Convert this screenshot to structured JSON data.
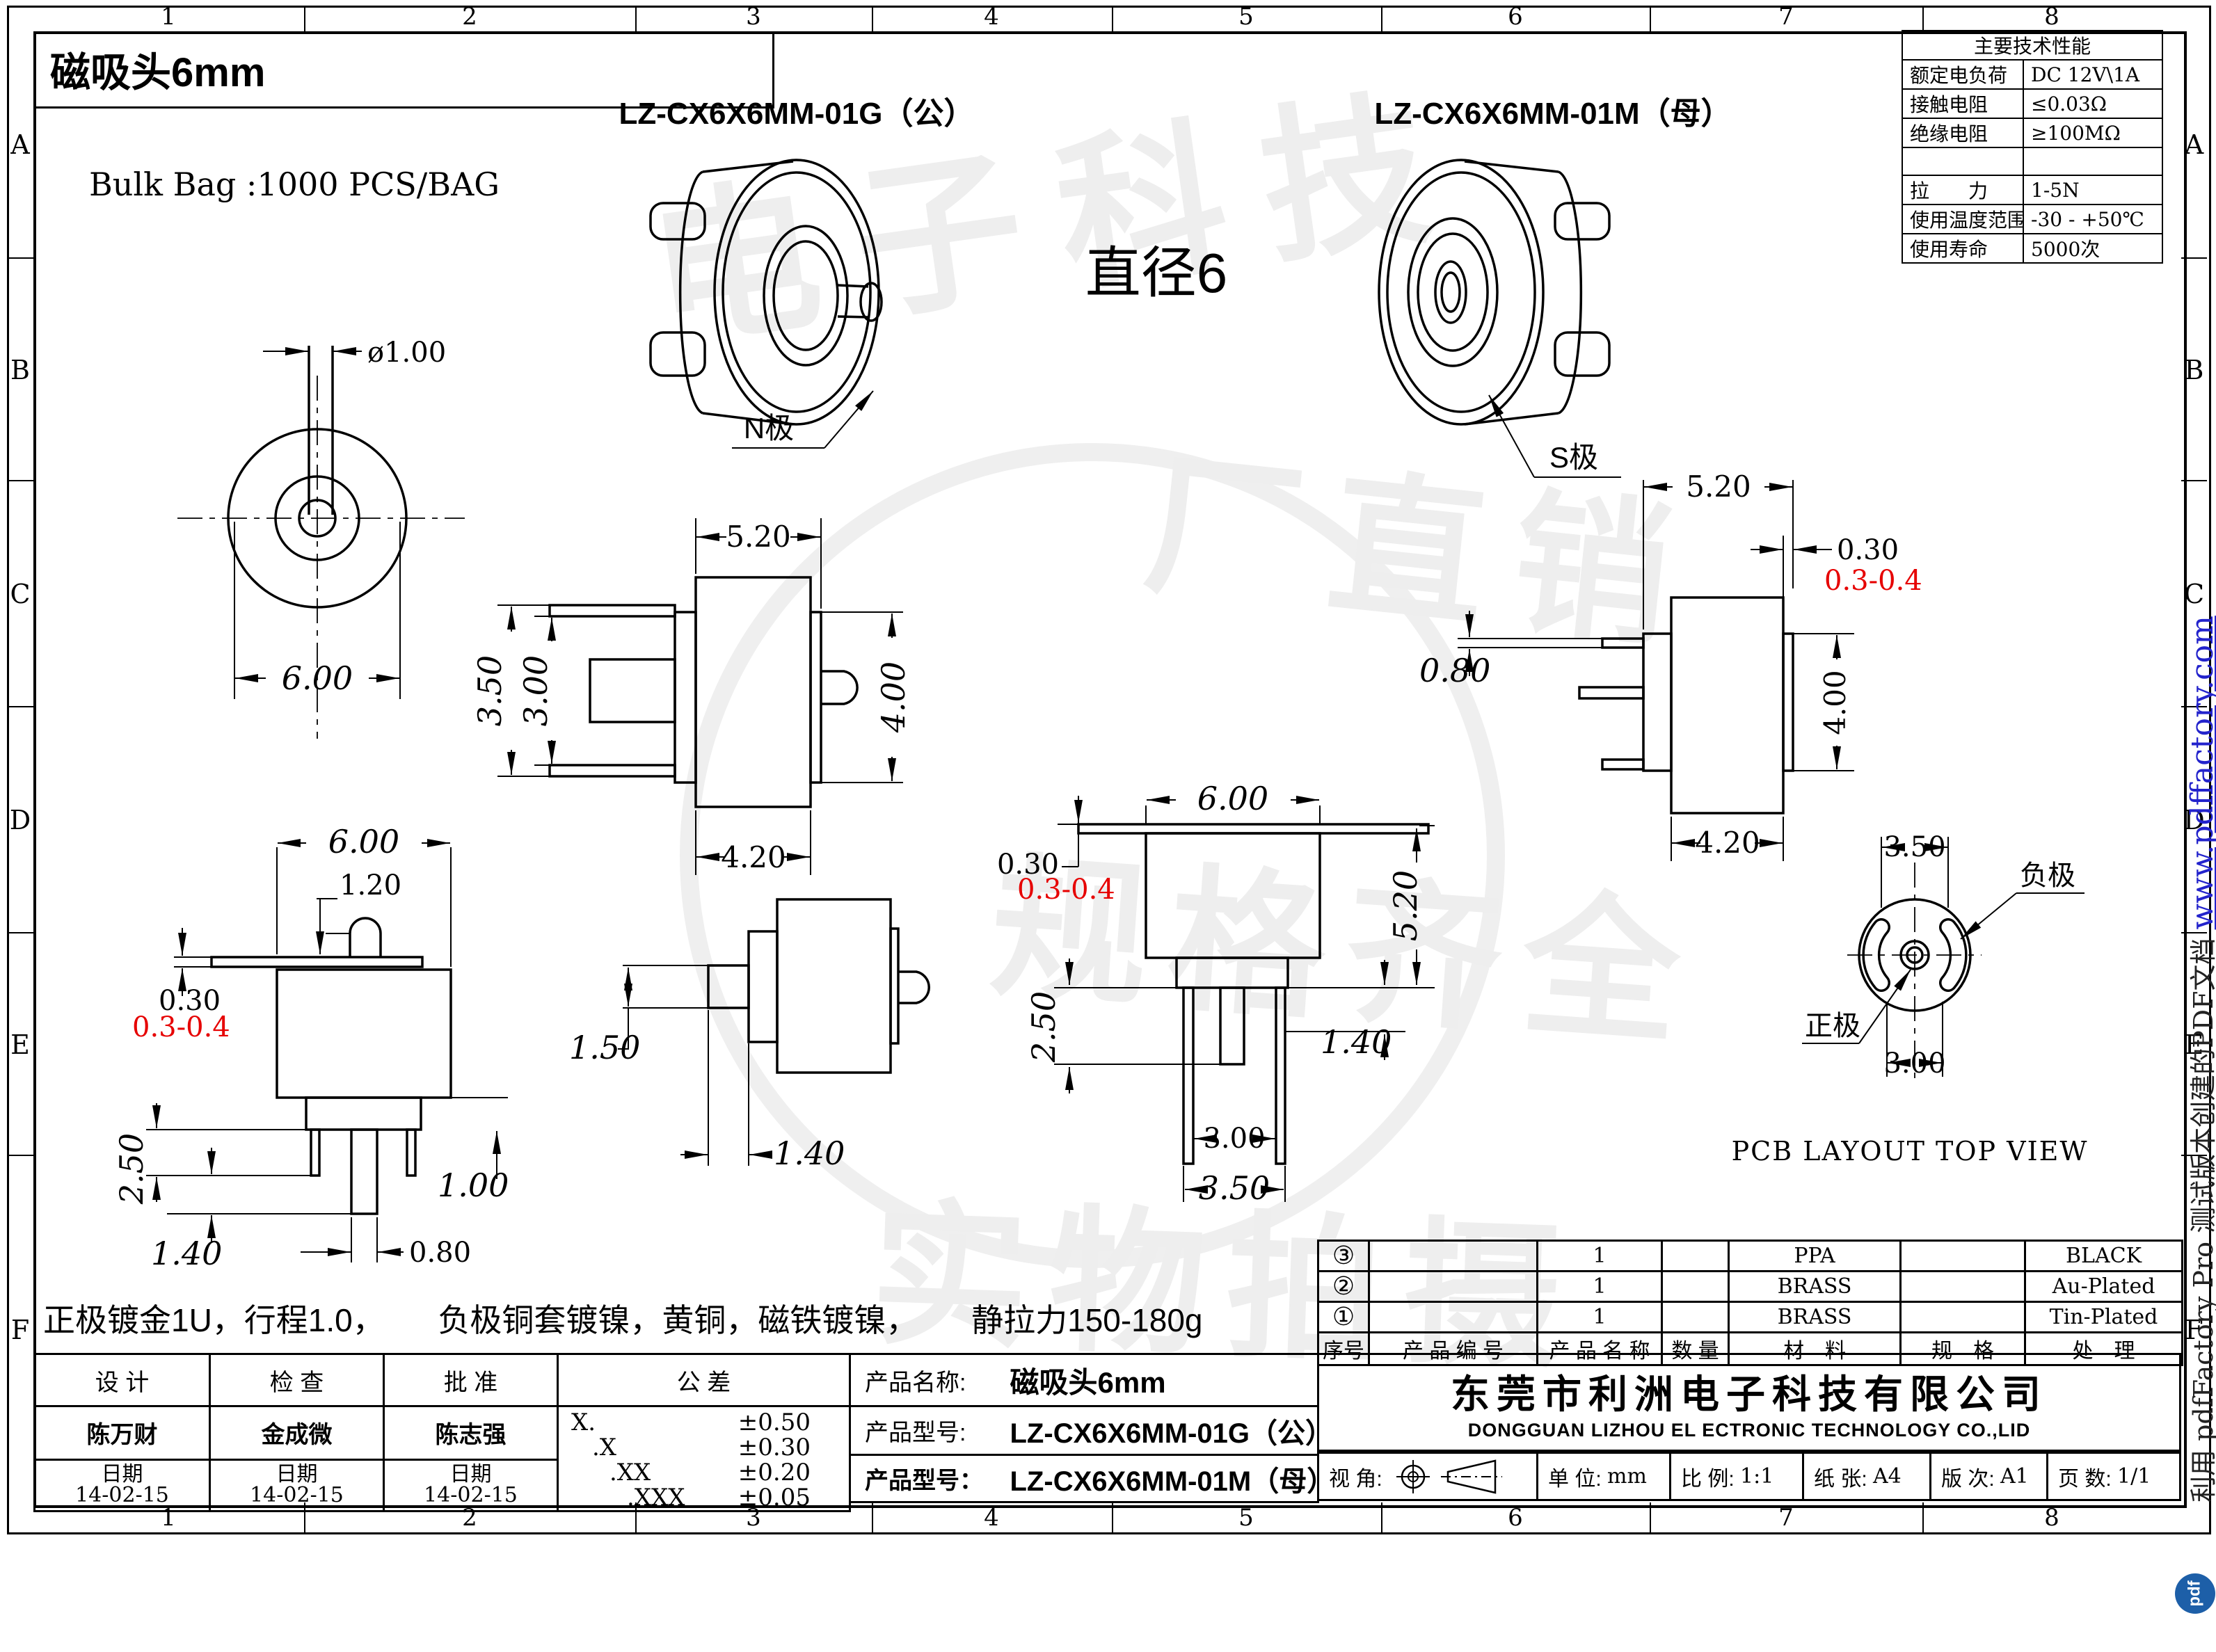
{
  "sheet": {
    "title": "磁吸头6mm",
    "bulk_bag": "Bulk Bag :1000 PCS/BAG",
    "diameter_note": "直径6",
    "note_line": "正极镀金1U，行程1.0，      负极铜套镀镍，黄铜，磁铁镀镍，      静拉力150-180g",
    "pcb_caption": "PCB LAYOUT TOP VIEW"
  },
  "iso": {
    "male_label": "LZ-CX6X6MM-01G（公）",
    "female_label": "LZ-CX6X6MM-01M（母）",
    "n_pole": "N极",
    "s_pole": "S极"
  },
  "spec": {
    "title": "主要技术性能",
    "rows": [
      {
        "k": "额定电负荷",
        "v": "DC 12V\\1A"
      },
      {
        "k": "接触电阻",
        "v": "≤0.03Ω"
      },
      {
        "k": "绝缘电阻",
        "v": "≥100MΩ"
      },
      {
        "k": "",
        "v": ""
      },
      {
        "k": "拉　　力",
        "v": "1-5N"
      },
      {
        "k": "使用温度范围",
        "v": "-30 - +50℃"
      },
      {
        "k": "使用寿命",
        "v": "5000次"
      }
    ]
  },
  "dims": {
    "front": {
      "pin": "ø1.00",
      "od": "6.00"
    },
    "male_side": {
      "top": "5.20",
      "outer": "3.50",
      "inner": "3.00",
      "right": "4.00",
      "bottom": "4.20"
    },
    "female_side": {
      "top": "5.20",
      "flange": "0.30",
      "flange_tol": "0.3-0.4",
      "lead": "0.80",
      "right": "4.00",
      "bottom": "4.20"
    },
    "male_front": {
      "width": "6.00",
      "pin": "1.20",
      "flange": "0.30",
      "flange_tol": "0.3-0.4",
      "pin_len": "2.50",
      "pin_ext": "1.40",
      "step": "1.00",
      "center_pin": "0.80"
    },
    "small_side": {
      "lead": "1.50",
      "offset": "1.40"
    },
    "female_front": {
      "width": "6.00",
      "flange": "0.30",
      "flange_tol": "0.3-0.4",
      "height": "5.20",
      "pin_len": "2.50",
      "step": "1.40",
      "pitch": "3.00",
      "span": "3.50"
    },
    "pcb": {
      "top": "3.50",
      "bottom": "3.00",
      "neg": "负极",
      "pos": "正极"
    }
  },
  "bom": {
    "headers": [
      "序号",
      "产 品 编 号",
      "产 品 名 称",
      "数 量",
      "材　料",
      "规　格",
      "处　理"
    ],
    "rows": [
      [
        "③",
        "",
        "1",
        "",
        "PPA",
        "",
        "BLACK"
      ],
      [
        "②",
        "",
        "1",
        "",
        "BRASS",
        "",
        "Au-Plated"
      ],
      [
        "①",
        "",
        "1",
        "",
        "BRASS",
        "",
        "Tin-Plated"
      ]
    ]
  },
  "tblock": {
    "design": "设  计",
    "check": "检  查",
    "approve": "批  准",
    "tol": "公  差",
    "designer": "陈万财",
    "checker": "金成微",
    "approver": "陈志强",
    "date_label": "日期",
    "date": "14-02-15",
    "tol_rows": [
      {
        "k": "X.",
        "v": "±0.50"
      },
      {
        "k": ".X",
        "v": "±0.30"
      },
      {
        "k": ".XX",
        "v": "±0.20"
      },
      {
        "k": ".XXX",
        "v": "±0.05"
      }
    ],
    "name_label": "产品名称:",
    "name": "磁吸头6mm",
    "model_label": "产品型号:",
    "model_g": "LZ-CX6X6MM-01G（公）",
    "model_label_b": "产品型号：",
    "model_m": "LZ-CX6X6MM-01M（母）"
  },
  "company": {
    "cn": "东莞市利洲电子科技有限公司",
    "en": "DONGGUAN LIZHOU EL ECTRONIC TECHNOLOGY CO.,LID"
  },
  "footer": {
    "view_label": "视 角:",
    "unit_label": "单 位:",
    "unit": "mm",
    "scale_label": "比 例:",
    "scale": "1:1",
    "paper_label": "纸 张:",
    "paper": "A4",
    "rev_label": "版 次:",
    "rev": "A1",
    "pages_label": "页 数:",
    "pages": "1/1"
  },
  "border": {
    "cols": [
      "1",
      "2",
      "3",
      "4",
      "5",
      "6",
      "7",
      "8"
    ],
    "rows": [
      "A",
      "B",
      "C",
      "D",
      "E",
      "F"
    ]
  },
  "sidebar": {
    "note": "利用 pdfFactory Pro 测试版本创建的PDF文档 ",
    "url": "www.pdffactory.com",
    "logo": "pdf"
  },
  "watermark": {
    "w1": "电子科技",
    "w2": "厂直销",
    "w3": "规格齐全",
    "w4": "实物拍摄"
  },
  "colors": {
    "red": "#e60000",
    "blue": "#2323cc",
    "logo_blue": "#1d5fa8"
  }
}
